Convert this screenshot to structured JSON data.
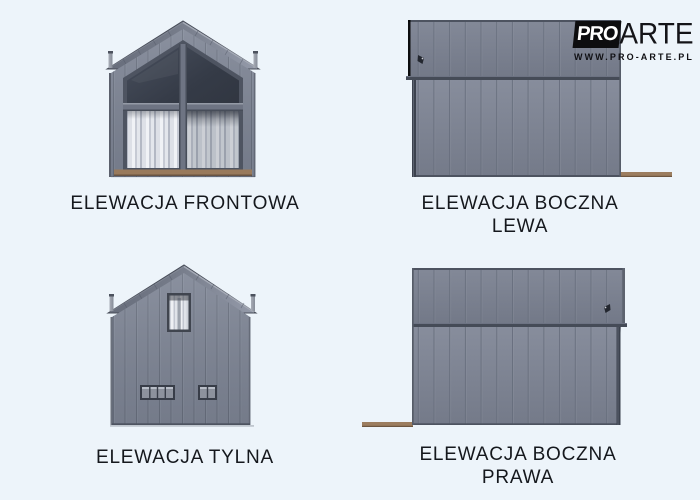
{
  "page": {
    "background_color": "#edf4fa"
  },
  "logo": {
    "pro": "PRO",
    "arte": "ARTE",
    "website": "WWW.PRO-ARTE.PL"
  },
  "elevations": {
    "front": {
      "label": "ELEWACJA FRONTOWA"
    },
    "side_left": {
      "label_line1": "ELEWACJA BOCZNA",
      "label_line2": "LEWA"
    },
    "rear": {
      "label": "ELEWACJA TYLNA"
    },
    "side_right": {
      "label_line1": "ELEWACJA BOCZNA",
      "label_line2": "PRAWA"
    }
  },
  "colors": {
    "background": "#edf4fa",
    "facade_gray": "#7d8494",
    "roof_gray": "#767c8b",
    "window_glass_dark": "#343a46",
    "curtain_white": "#e6e8ed",
    "base_brown": "#9b7c5e",
    "gutter_dark": "#454b57",
    "label_text": "#15181d",
    "logo_black": "#0d0d0f"
  }
}
